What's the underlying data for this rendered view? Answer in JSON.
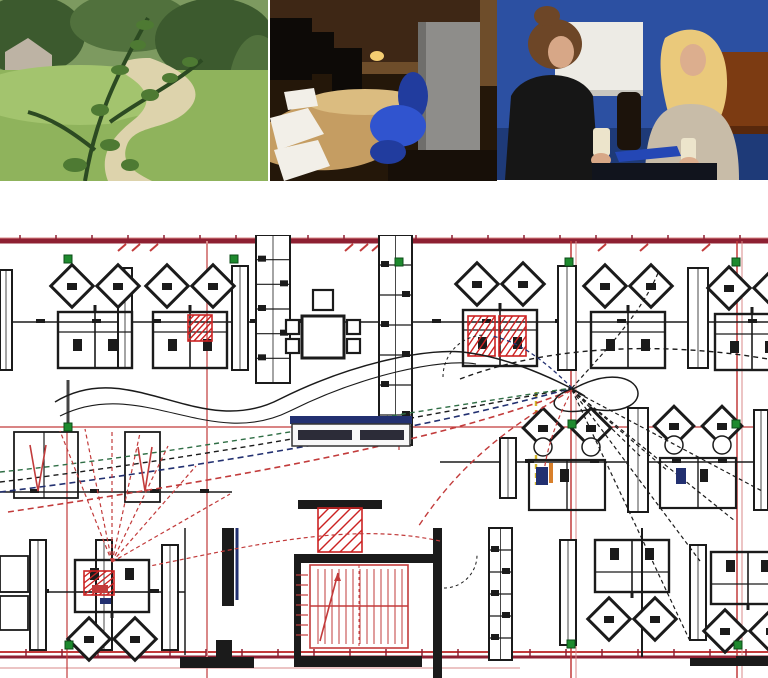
{
  "photos": [
    {
      "name": "landscape-path-photo",
      "palette": {
        "bgTop": "#7d9a60",
        "tree": "#51713d",
        "treeDark": "#3c5a2e",
        "grass": "#8fb35c",
        "grassLight": "#a3c46e",
        "path": "#ddd3ac",
        "roof": "#bdb3a4",
        "branch": "#2c4a22",
        "leaf": "#4e7a33"
      }
    },
    {
      "name": "office-interior-photo",
      "palette": {
        "bg": "#241709",
        "wall": "#3e2715",
        "wallLight": "#6e4d2a",
        "desk": "#c59d62",
        "deskLight": "#dbbc80",
        "monitor": "#0d0a07",
        "cabinet": "#8e8d8a",
        "cabinetDark": "#6f6e6b",
        "chair": "#3054cf",
        "chairDark": "#213c9e",
        "paper": "#f2efe8",
        "light": "#f4cd72",
        "floor": "#170f08"
      }
    },
    {
      "name": "two-women-talking-photo",
      "palette": {
        "wall": "#2c50a2",
        "wallDark": "#1e3a78",
        "board": "#edebe5",
        "boardEdge": "#c9c7c0",
        "brown": "#7c3b12",
        "brownDark": "#58280c",
        "hair1": "#6d4627",
        "face1": "#d7a787",
        "jacket": "#161616",
        "hair2": "#eac97b",
        "face2": "#dcae8e",
        "sweater": "#c8bca8",
        "cup": "#ece4cb",
        "table": "#11141d",
        "folder": "#2447b5",
        "bottle": "#1c130b"
      }
    }
  ],
  "floor_plan": {
    "colors": {
      "ink": "#1b1b1b",
      "red": "#c23b3b",
      "darkred": "#8e2032",
      "pink": "#d98888",
      "green": "#1e8a2e",
      "navy": "#223070",
      "yellow": "#d4b62a",
      "orange": "#d87f2a",
      "dkgreen": "#2f6e45",
      "grey": "#444444"
    },
    "h_lines": [
      {
        "y": 3,
        "x1": 0,
        "x2": 768,
        "c": "pink",
        "w": 1
      },
      {
        "y": 6,
        "x1": 0,
        "x2": 768,
        "c": "darkred",
        "w": 5
      },
      {
        "y": 192,
        "x1": 0,
        "x2": 768,
        "c": "red",
        "w": 1.2
      },
      {
        "y": 417,
        "x1": 0,
        "x2": 768,
        "c": "red",
        "w": 2
      },
      {
        "y": 422,
        "x1": 0,
        "x2": 768,
        "c": "darkred",
        "w": 3
      },
      {
        "y": 433,
        "x1": 0,
        "x2": 520,
        "c": "pink",
        "w": 1
      }
    ],
    "v_lines": [
      {
        "x": 207,
        "y1": 6,
        "y2": 443,
        "c": "pink",
        "w": 2
      },
      {
        "x": 399,
        "y1": 6,
        "y2": 215,
        "c": "pink",
        "w": 2
      },
      {
        "x": 571,
        "y1": 6,
        "y2": 443,
        "c": "red",
        "w": 1.5
      },
      {
        "x": 576,
        "y1": 6,
        "y2": 443,
        "c": "pink",
        "w": 1
      },
      {
        "x": 737,
        "y1": 6,
        "y2": 443,
        "c": "red",
        "w": 1.5
      },
      {
        "x": 742,
        "y1": 6,
        "y2": 443,
        "c": "pink",
        "w": 1
      },
      {
        "x": 67,
        "y1": 192,
        "y2": 443,
        "c": "red",
        "w": 1.2
      },
      {
        "x": 536,
        "y1": 157,
        "y2": 250,
        "c": "yellow",
        "w": 2.4,
        "dash": "5 4"
      }
    ],
    "tick_rows": [
      {
        "start": 20,
        "step": 36,
        "count": 21,
        "y1": 0,
        "y2": 6
      },
      {
        "start": 26,
        "step": 36,
        "count": 21,
        "y1": 414,
        "y2": 421
      }
    ],
    "red_ticks": [
      118,
      132,
      150,
      345,
      360,
      372,
      598,
      640,
      702
    ],
    "wall_lines": [
      {
        "x1": 0,
        "y1": 87,
        "x2": 768,
        "y2": 87,
        "w": 1.5
      },
      {
        "x1": 440,
        "y1": 227,
        "x2": 768,
        "y2": 227,
        "w": 1.5
      },
      {
        "x1": 0,
        "y1": 257,
        "x2": 232,
        "y2": 257,
        "w": 1.5
      },
      {
        "x1": 0,
        "y1": 357,
        "x2": 185,
        "y2": 357,
        "w": 1.5
      },
      {
        "x1": 185,
        "y1": 293,
        "x2": 185,
        "y2": 420,
        "w": 1.5
      },
      {
        "x1": 642,
        "y1": 293,
        "x2": 642,
        "y2": 422,
        "w": 2
      },
      {
        "x1": 68,
        "y1": 145,
        "x2": 68,
        "y2": 192,
        "w": 3,
        "c": "#444444"
      }
    ],
    "door_stops": [
      {
        "y": 84,
        "xs": [
          36,
          92,
          152,
          250,
          292,
          432,
          482,
          555,
          617,
          692,
          748
        ]
      },
      {
        "y": 224,
        "xs": [
          525,
          590,
          672,
          718
        ]
      },
      {
        "y": 354,
        "xs": [
          40,
          95,
          150
        ]
      },
      {
        "y": 254,
        "xs": [
          30,
          90,
          150,
          200
        ]
      }
    ],
    "walls": [
      [
        294,
        319,
        148,
        9
      ],
      [
        433,
        293,
        9,
        150
      ],
      [
        294,
        421,
        128,
        11
      ],
      [
        298,
        265,
        84,
        9
      ],
      [
        294,
        328,
        7,
        95
      ],
      [
        216,
        405,
        16,
        17
      ],
      [
        222,
        293,
        12,
        78
      ],
      [
        180,
        422,
        74,
        11
      ],
      [
        690,
        423,
        78,
        8
      ],
      [
        736,
        421,
        32,
        9
      ]
    ],
    "navy_bars": [
      {
        "x1": 237,
        "y1": 293,
        "x2": 237,
        "y2": 365,
        "w": 3
      }
    ],
    "cabinets": [
      [
        118,
        33,
        14,
        100
      ],
      [
        232,
        31,
        16,
        104
      ],
      [
        0,
        35,
        12,
        100
      ],
      [
        558,
        31,
        18,
        104
      ],
      [
        688,
        33,
        20,
        100
      ],
      [
        500,
        203,
        16,
        60
      ],
      [
        628,
        173,
        20,
        104
      ],
      [
        754,
        175,
        14,
        100
      ],
      [
        30,
        305,
        16,
        110
      ],
      [
        96,
        305,
        16,
        110
      ],
      [
        162,
        310,
        16,
        105
      ],
      [
        560,
        305,
        16,
        105
      ],
      [
        690,
        310,
        16,
        95
      ]
    ],
    "seg_cabinets": [
      [
        256,
        0,
        34,
        148,
        6
      ],
      [
        379,
        0,
        33,
        210,
        7
      ],
      [
        489,
        293,
        23,
        132,
        6
      ]
    ],
    "boxes": [
      {
        "x": 14,
        "y": 197,
        "w": 64,
        "h": 66,
        "div": 44
      },
      {
        "x": 125,
        "y": 197,
        "w": 35,
        "h": 70
      },
      {
        "x": 0,
        "y": 321,
        "w": 28,
        "h": 36
      },
      {
        "x": 0,
        "y": 361,
        "w": 28,
        "h": 34
      }
    ],
    "clusters": [
      {
        "cx": 95,
        "top": 30,
        "dir": "up"
      },
      {
        "cx": 190,
        "top": 30,
        "dir": "up"
      },
      {
        "cx": 500,
        "top": 28,
        "dir": "up"
      },
      {
        "cx": 628,
        "top": 30,
        "dir": "up"
      },
      {
        "cx": 752,
        "top": 32,
        "dir": "up"
      },
      {
        "cx": 567,
        "top": 175,
        "dir": "mid"
      },
      {
        "cx": 698,
        "top": 173,
        "dir": "mid"
      },
      {
        "cx": 112,
        "top": 325,
        "dir": "down"
      },
      {
        "cx": 632,
        "top": 305,
        "dir": "down"
      },
      {
        "cx": 748,
        "top": 317,
        "dir": "down"
      }
    ],
    "meeting_table": {
      "x": 302,
      "y": 81,
      "w": 42,
      "h": 42,
      "chairs": [
        [
          286,
          85,
          13,
          14
        ],
        [
          286,
          104,
          13,
          14
        ],
        [
          347,
          85,
          13,
          14
        ],
        [
          347,
          104,
          13,
          14
        ],
        [
          313,
          55,
          20,
          20
        ]
      ]
    },
    "red_hatch_boxes": [
      [
        188,
        80,
        24,
        26
      ],
      [
        468,
        81,
        27,
        40
      ],
      [
        499,
        81,
        27,
        40
      ],
      [
        318,
        273,
        44,
        44
      ],
      [
        84,
        336,
        30,
        24
      ]
    ],
    "stair": {
      "outer": [
        310,
        330,
        98,
        83
      ],
      "stepX1": 318,
      "stepX2": 402,
      "stepStep": 7,
      "stepY1": 334,
      "stepY2": 409,
      "midY": 371,
      "dashX": 359,
      "arrow": [
        320,
        406,
        338,
        338
      ],
      "hatchX1": 296,
      "hatchX2": 308,
      "hatchY1": 340,
      "hatchY2": 408,
      "hatchStep": 10
    },
    "markers": [
      [
        68,
        24
      ],
      [
        234,
        24
      ],
      [
        399,
        27
      ],
      [
        569,
        27
      ],
      [
        736,
        27
      ],
      [
        68,
        192
      ],
      [
        572,
        189
      ],
      [
        736,
        189
      ],
      [
        69,
        410
      ],
      [
        571,
        409
      ],
      [
        738,
        410
      ]
    ],
    "label_box": {
      "bar": [
        290,
        181,
        122,
        8
      ],
      "box": [
        292,
        189,
        118,
        22
      ],
      "smudges": [
        [
          298,
          195,
          54,
          10
        ],
        [
          360,
          195,
          44,
          10
        ]
      ],
      "text": ""
    },
    "marks": [
      {
        "x": 92,
        "y": 350,
        "w": 16,
        "h": 8,
        "c": "red"
      },
      {
        "x": 100,
        "y": 363,
        "w": 11,
        "h": 6,
        "c": "navy"
      },
      {
        "x": 536,
        "y": 232,
        "w": 12,
        "h": 18,
        "c": "navy"
      },
      {
        "x": 560,
        "y": 234,
        "w": 9,
        "h": 13,
        "c": "ink"
      },
      {
        "x": 676,
        "y": 233,
        "w": 10,
        "h": 16,
        "c": "navy"
      },
      {
        "x": 700,
        "y": 234,
        "w": 8,
        "h": 13,
        "c": "ink"
      },
      {
        "x": 549,
        "y": 228,
        "w": 4,
        "h": 20,
        "c": "orange"
      }
    ],
    "cables": [
      {
        "c": "navy",
        "w": 1.6,
        "dash": "6 4",
        "d": "M0,257 C180,235 420,196 572,153"
      },
      {
        "c": "ink",
        "w": 1.4,
        "dash": "5 4",
        "d": "M0,247 C180,226 400,186 572,153"
      },
      {
        "c": "dkgreen",
        "w": 1.4,
        "dash": "5 4",
        "d": "M0,237 C160,221 380,181 572,153"
      },
      {
        "c": "red",
        "w": 1.6,
        "dash": "6 4",
        "d": "M8,277 C200,248 430,211 572,155"
      },
      {
        "c": "red",
        "w": 1.4,
        "dash": "6 4",
        "d": "M572,155 C500,196 455,236 418,292"
      },
      {
        "c": "ink",
        "w": 1.5,
        "dash": "",
        "d": "M55,167 C130,121 200,206 280,164 C350,129 430,111 470,118 C540,128 612,178 574,155"
      },
      {
        "c": "ink",
        "w": 1.1,
        "dash": "",
        "d": "M60,181 C140,141 210,216 290,176 C360,141 440,123 476,129"
      },
      {
        "c": "ink",
        "w": 1.5,
        "dash": "",
        "d": "M575,153 C645,116 665,186 592,174 C546,184 544,161 575,153"
      },
      {
        "c": "ink",
        "w": 1.4,
        "dash": "5 4",
        "d": "M460,144 C560,106 680,109 768,124"
      },
      {
        "c": "ink",
        "w": 1.2,
        "dash": "4 3",
        "d": "M572,155 L640,221"
      },
      {
        "c": "ink",
        "w": 1.2,
        "dash": "4 3",
        "d": "M572,155 L668,236"
      },
      {
        "c": "ink",
        "w": 1.2,
        "dash": "4 3",
        "d": "M572,155 L700,326"
      },
      {
        "c": "ink",
        "w": 1.2,
        "dash": "4 3",
        "d": "M572,155 L735,286"
      },
      {
        "c": "ink",
        "w": 1.2,
        "dash": "4 3",
        "d": "M572,155 L762,256"
      },
      {
        "c": "ink",
        "w": 1.2,
        "dash": "4 3",
        "d": "M572,155 L690,406"
      },
      {
        "c": "navy",
        "w": 1.3,
        "dash": "4 3",
        "d": "M572,153 C540,121 516,106 492,101"
      },
      {
        "c": "ink",
        "w": 1.2,
        "dash": "4 3",
        "d": "M572,153 C600,121 640,81 658,38"
      },
      {
        "c": "red",
        "w": 1.2,
        "dash": "4 3",
        "d": "M440,306 C350,286 250,311 150,331"
      },
      {
        "c": "red",
        "w": 1.2,
        "dash": "4 3",
        "d": "M112,327 L60,196"
      },
      {
        "c": "red",
        "w": 1.2,
        "dash": "4 3",
        "d": "M112,327 L85,194"
      },
      {
        "c": "red",
        "w": 1.2,
        "dash": "4 3",
        "d": "M112,327 L112,196"
      },
      {
        "c": "red",
        "w": 1.2,
        "dash": "4 3",
        "d": "M112,327 L140,198"
      },
      {
        "c": "red",
        "w": 1.2,
        "dash": "4 3",
        "d": "M112,327 L168,211"
      },
      {
        "c": "red",
        "w": 1.2,
        "dash": "4 3",
        "d": "M112,327 L196,231"
      },
      {
        "c": "red",
        "w": 1.2,
        "dash": "4 3",
        "d": "M112,327 L230,259"
      },
      {
        "c": "red",
        "w": 1.6,
        "dash": "",
        "d": "M30,210 L38,256 L46,210"
      },
      {
        "c": "red",
        "w": 1.6,
        "dash": "",
        "d": "M138,212 L145,256 L152,212"
      },
      {
        "c": "ink",
        "w": 1,
        "dash": "3 3",
        "d": "M443,142 A42,42 0 0 1 485,100"
      },
      {
        "c": "ink",
        "w": 1,
        "dash": "3 3",
        "d": "M444,353 A33,33 0 0 0 477,320"
      },
      {
        "c": "red",
        "w": 1.2,
        "dash": "4 3",
        "d": "M572,155 C556,186 548,210 544,236"
      }
    ]
  }
}
